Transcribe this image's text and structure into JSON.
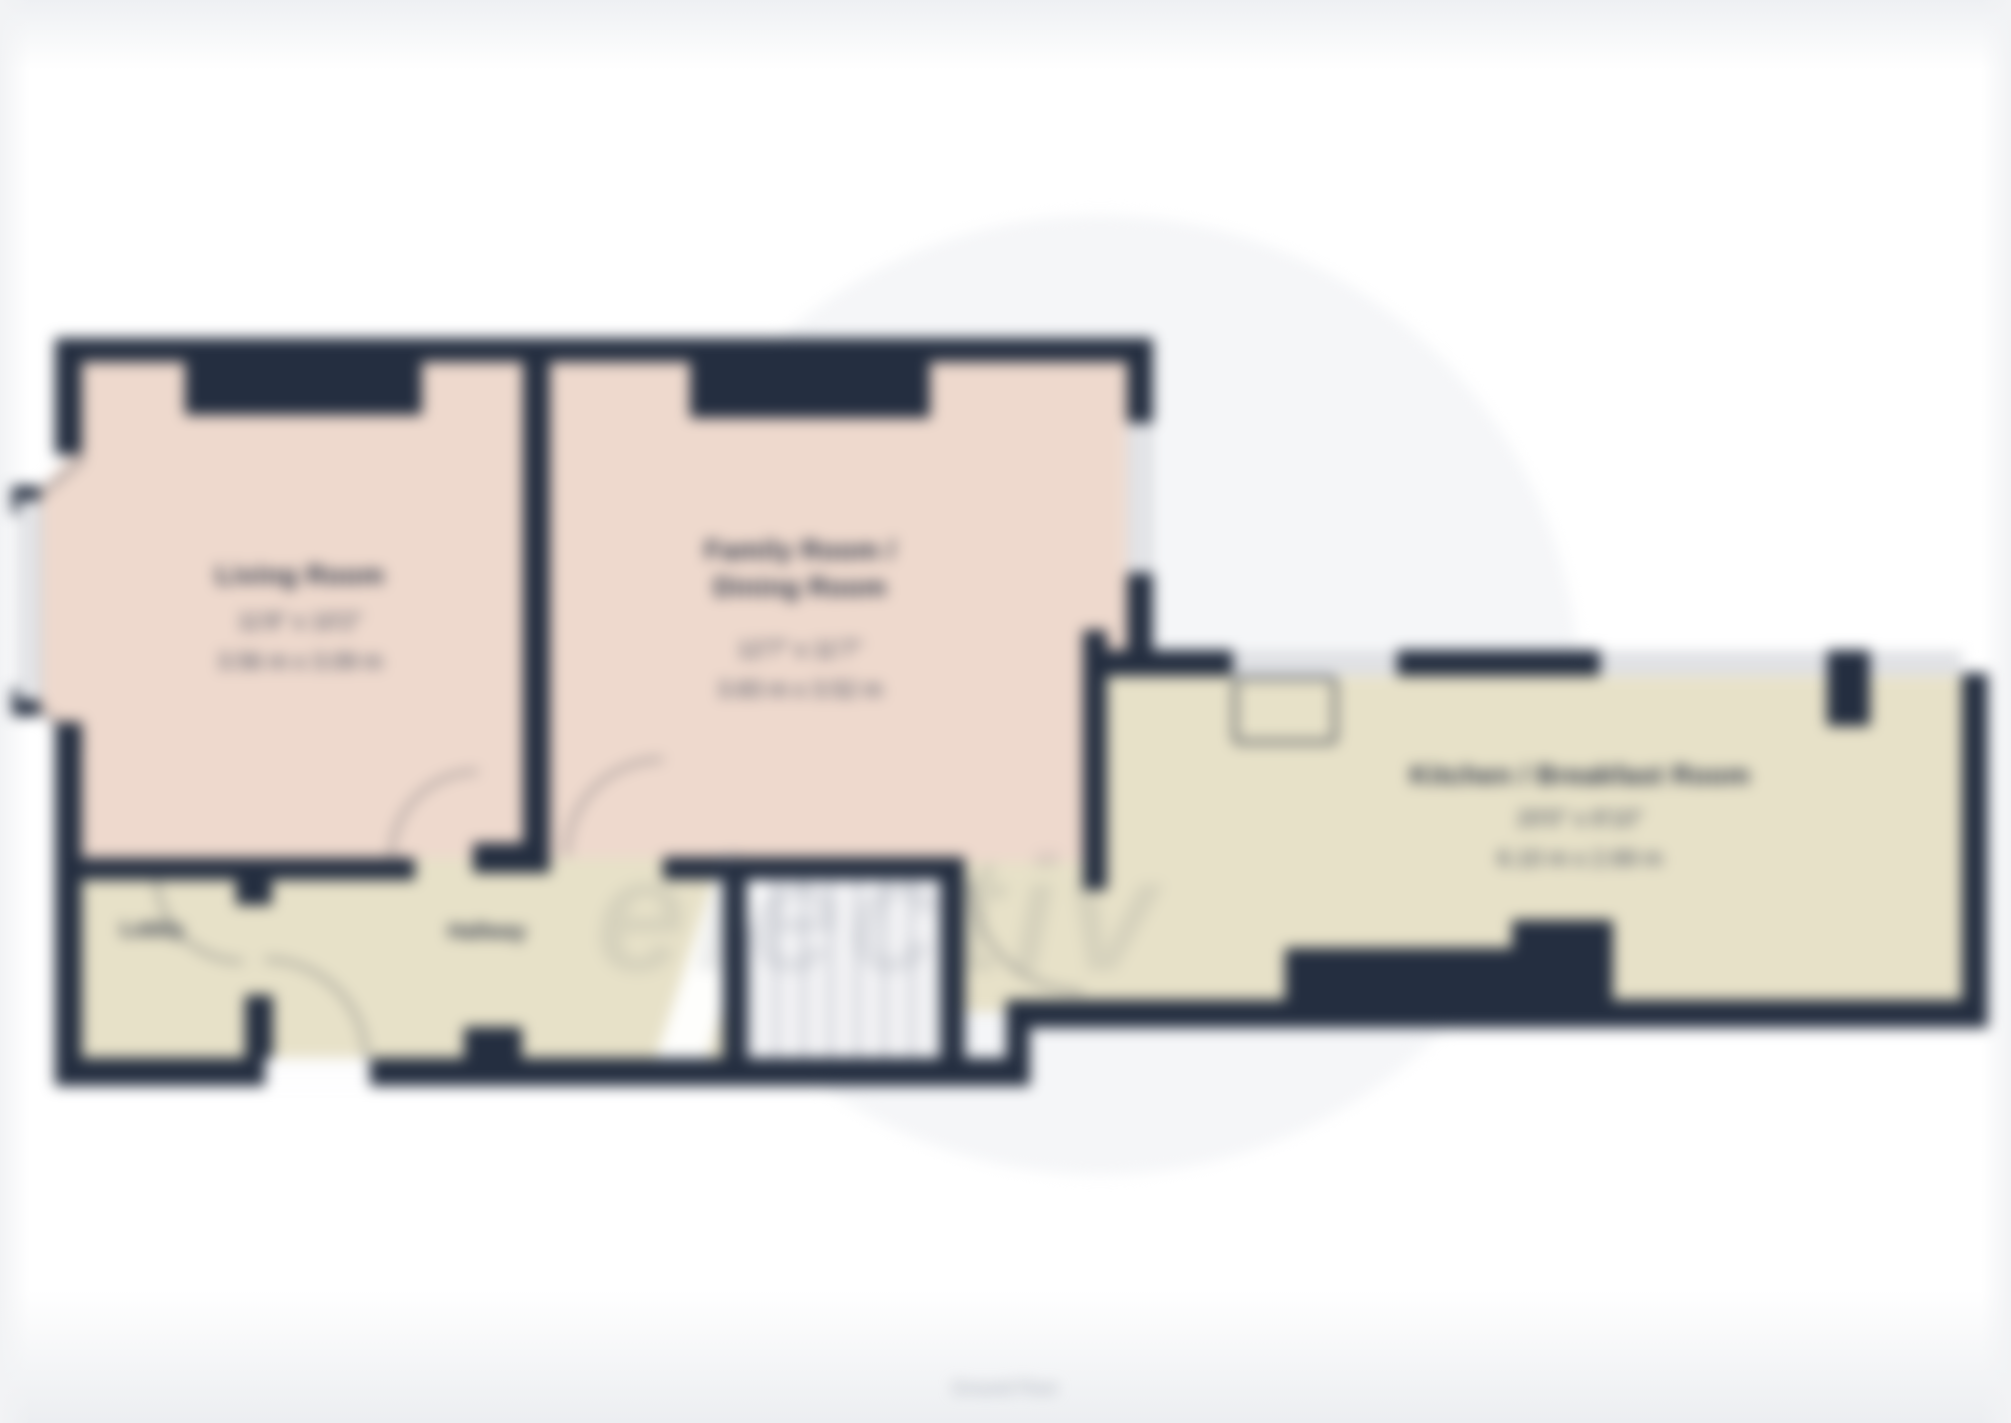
{
  "page": {
    "caption": "Ground Floor",
    "watermark_text": "electiv"
  },
  "colors": {
    "wall": "#242e40",
    "living_family_floor": "#eed9cd",
    "kitchen_hall_floor": "#e7e1c8",
    "label_text": "#2a3345",
    "caption_text": "#a4aab4"
  },
  "rooms": {
    "living": {
      "name": "Living Room",
      "dims_ft": "11'8\" x 10'2\"",
      "dims_m": "3.56 m x 3.09 m"
    },
    "family": {
      "name_line1": "Family Room /",
      "name_line2": "Dining Room",
      "dims_ft": "12'7\" x 11'7\"",
      "dims_m": "3.83 m x 3.52 m"
    },
    "kitchen": {
      "name": "Kitchen / Breakfast Room",
      "dims_ft": "20'0\" x 8'10\"",
      "dims_m": "6.10 m x 2.69 m"
    },
    "lobby": {
      "name": "Lobby"
    },
    "hallway": {
      "name": "Hallway"
    }
  }
}
